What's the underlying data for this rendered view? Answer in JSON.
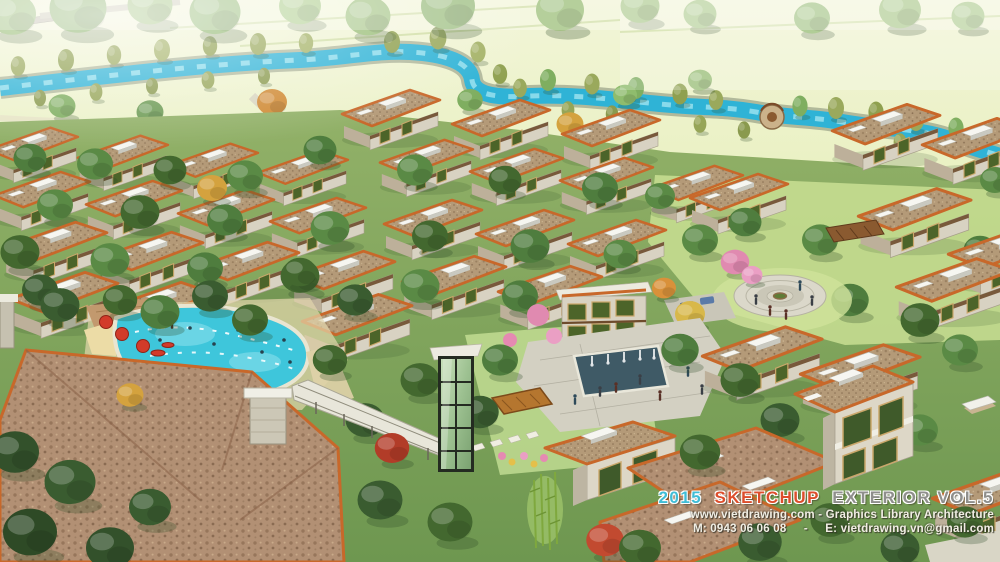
{
  "watermark": {
    "title_year": "2015",
    "title_brand": "SKETCHUP",
    "title_rest": "EXTERIOR VOL.5",
    "info_line1": "www.vietdrawing.com - Graphics Library Architecture",
    "info_line2_phone": "M: 0943 06 06 08",
    "info_line2_separator": "-",
    "info_line2_email": "E: vietdrawing.vn@gmail.com"
  },
  "palette": {
    "title_year_color": "#3fbdd6",
    "title_brand_color": "#dd4e2c",
    "title_rest_color": "#8f8f8c",
    "info_text_color": "#f1eee4",
    "river": "#2fb3d6",
    "pool": "#3ec6db",
    "meadow": "#e7f0c4",
    "tree_canopy": "#6f9a50",
    "roof_tile": "#b49a78",
    "roof_fascia": "#c8682a",
    "stone_facade": "#d8d2c2",
    "flat_roof_box": "#f6f6f1",
    "umbrella_red": "#d23b2a",
    "blossom_pink": "#e08ab0"
  }
}
